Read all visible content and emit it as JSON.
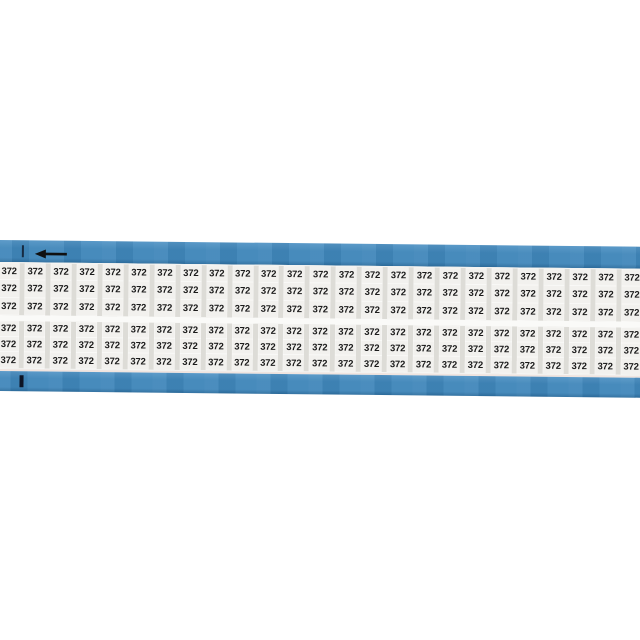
{
  "card": {
    "label_text": "372",
    "columns": 25,
    "banks": 2,
    "rows_per_bank": 3,
    "total_labels": 150,
    "arrow_direction": "left"
  },
  "colors": {
    "background": "#ffffff",
    "tape_blue": "#4187ba",
    "tape_blue_highlight": "#5596c6",
    "tape_blue_shadow": "#2f6f9f",
    "marker_cell": "#f2f1ee",
    "cell_gutter": "#dddcd7",
    "bank_gap": "#fafaf8",
    "edge_tint": "#f0e4df",
    "marker_text": "#1b1b1b",
    "registration_mark": "#0d1424",
    "arrow": "#101010"
  }
}
